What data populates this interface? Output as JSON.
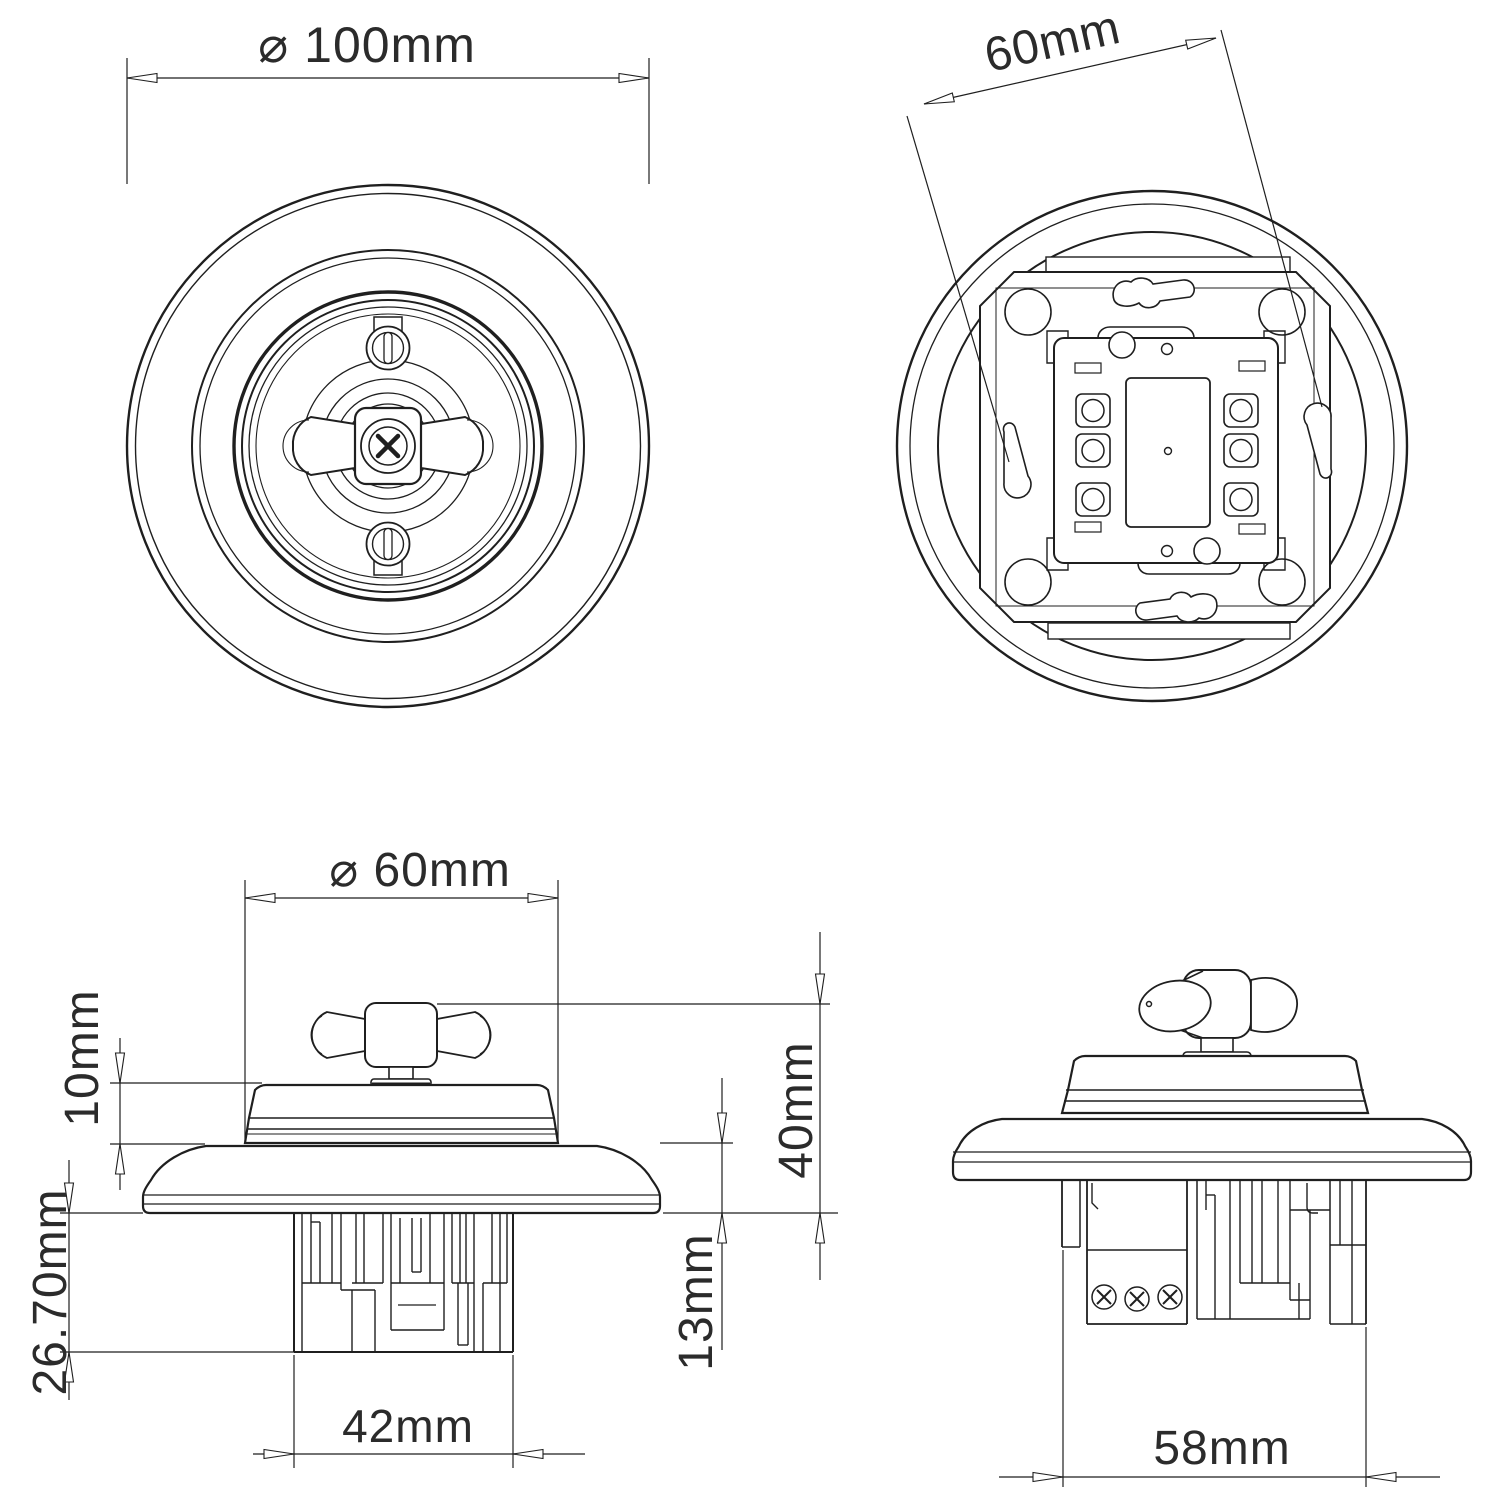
{
  "drawing": {
    "background": "#ffffff",
    "line_color": "#1f1f1f",
    "views": {
      "front": {
        "label": "front-view-of-round-rotary-switch",
        "dim_plate_diameter": "⌀ 100mm"
      },
      "back": {
        "label": "back-view-with-mounting-mechanism",
        "dim_mounting_hole_spacing": "60mm"
      },
      "side_front": {
        "label": "side-elevation-facing-toggle",
        "dim_cover_diameter": "⌀ 60mm",
        "dim_cover_height": "10mm",
        "dim_recess_depth": "26.70mm",
        "dim_overall_height": "40mm",
        "dim_plate_height": "13mm",
        "dim_mechanism_width": "42mm"
      },
      "side_profile": {
        "label": "side-elevation-profile",
        "dim_mechanism_width": "58mm"
      }
    }
  }
}
